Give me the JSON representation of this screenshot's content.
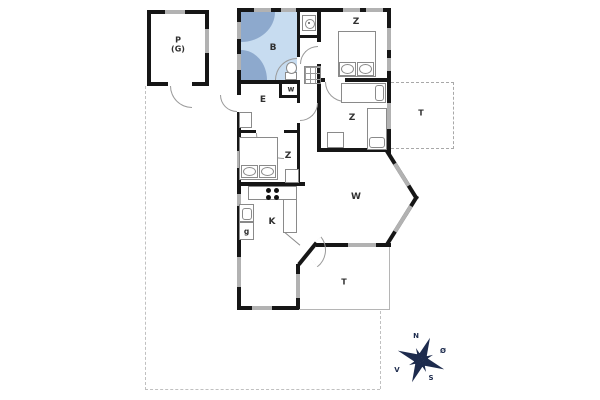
{
  "plan": {
    "garage_label_line1": "P",
    "garage_label_line2": "(G)",
    "bathroom": "B",
    "wc": "w",
    "entry": "E",
    "bedroom_top": "Z",
    "bedroom_mid": "Z",
    "bedroom_left": "Z",
    "kitchen": "K",
    "appliance": "g",
    "living": "W",
    "terrace_east": "T",
    "terrace_south": "T"
  },
  "compass": {
    "north": "N",
    "east": "Ø",
    "south": "S",
    "west": "V"
  },
  "colors": {
    "wall": "#161616",
    "window": "#b2b2b2",
    "bath_fill": "#c7dcf0",
    "bath_fixture": "#8da9cd",
    "compass": "#1d2b4d",
    "boundary": "#c0c0c0"
  }
}
